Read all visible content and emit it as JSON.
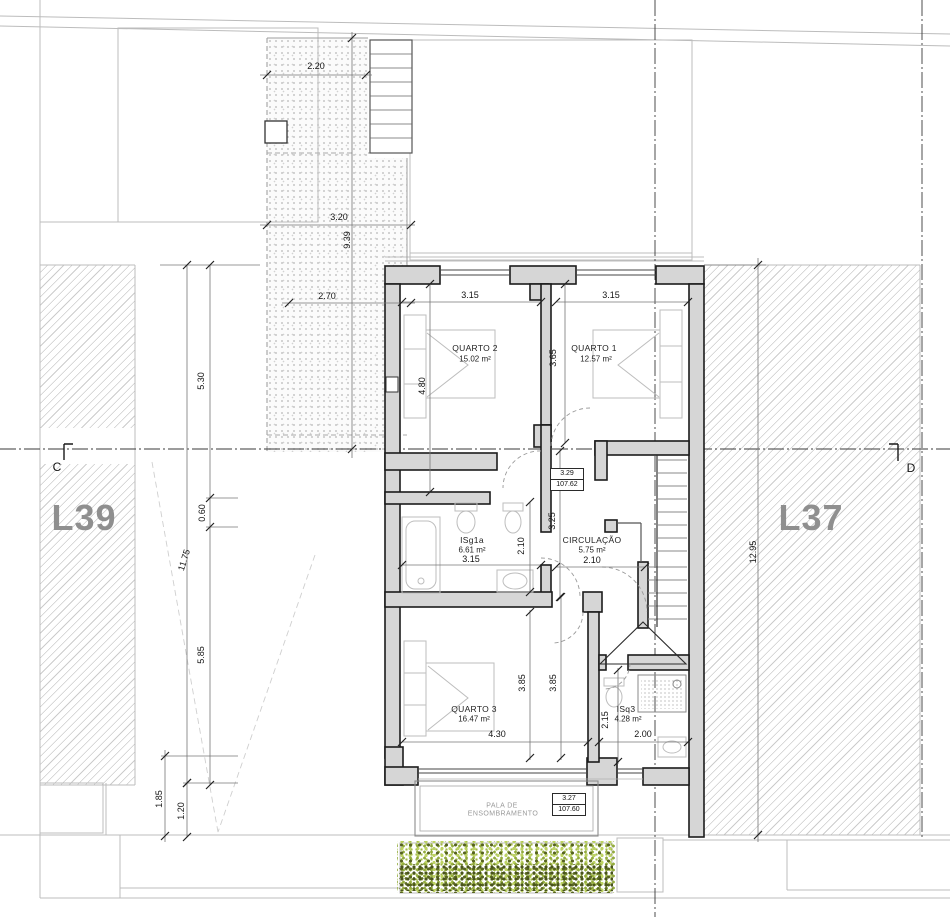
{
  "site": {
    "lot_left": "L39",
    "lot_right": "L37",
    "section_left": "C",
    "section_right": "D",
    "colors": {
      "wall_fill": "#d6d6d6",
      "wall_stroke": "#1c1c1c",
      "hatch_line": "#cccccc",
      "vegetation_light": "#bdd363",
      "vegetation_dark": "#55621f"
    }
  },
  "rooms": {
    "quarto2": {
      "name": "QUARTO 2",
      "area": "15.02 m²"
    },
    "quarto1": {
      "name": "QUARTO 1",
      "area": "12.57 m²"
    },
    "isg1a": {
      "name": "ISg1a",
      "area": "6.61 m²"
    },
    "circulacao": {
      "name": "CIRCULAÇÃO",
      "area": "5.75 m²"
    },
    "quarto3": {
      "name": "QUARTO 3",
      "area": "16.47 m²"
    },
    "isq3": {
      "name": "ISq3",
      "area": "4.28 m²"
    }
  },
  "levels": {
    "upper": {
      "value": "3.29",
      "elevation": "107.62"
    },
    "lower": {
      "value": "3.27",
      "elevation": "107.60"
    }
  },
  "canopy": {
    "line1": "PALA DE",
    "line2": "ENSOMBRAMENTO"
  },
  "dims": {
    "terrace_width_top": "2.20",
    "terrace_width_mid": "3.20",
    "terrace_length": "9.39",
    "terrace_width_low": "2.70",
    "left_upper": "5.30",
    "left_step": "0.60",
    "left_total": "11.75",
    "left_lower": "5.85",
    "left_canopy_a": "1.85",
    "left_canopy_b": "1.20",
    "right_total": "12.95",
    "quarto2_w": "3.15",
    "quarto2_h": "4.80",
    "quarto1_w": "3.15",
    "quarto1_h": "3.65",
    "hall_len": "3.25",
    "isg1a_w": "3.15",
    "isg1a_h": "2.10",
    "circ_w": "2.10",
    "quarto3_w": "4.30",
    "quarto3_h_a": "3.85",
    "quarto3_h_b": "3.85",
    "isq3_w": "2.00",
    "isq3_h": "2.15"
  }
}
